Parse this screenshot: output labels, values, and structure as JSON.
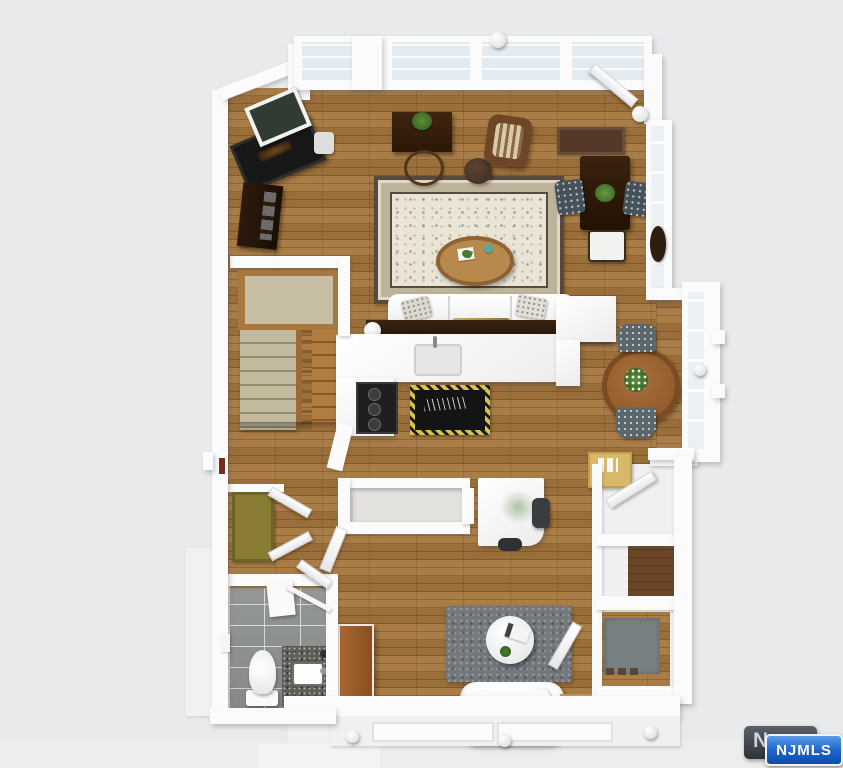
{
  "watermark": {
    "monogram": "N",
    "label": "NJMLS",
    "badge_blue": "#1a63c8",
    "badge_dark": "#3c4148"
  },
  "palette": {
    "background": "#e9eaeb",
    "wall": "#fbfbfc",
    "hardwood": "#a5763d",
    "hardwood_dark": "#6b4626",
    "window_glass": "#e4ebf0",
    "area_rug_ivory": "#eae4d4",
    "area_rug_border": "#57493e",
    "bath_tile_gray": "#8d918e",
    "shower_tile_beige": "#d9d2bc",
    "shag_rug_gray": "#73787c",
    "doormat_gray": "#798084",
    "stair_carpet_tan": "#c2ba9f",
    "granite_counter": "#5e5e59",
    "closet_door_olive": "#887d33",
    "armoire_wood": "#9a5a2a",
    "dark_wood_furniture": "#2c1a0c",
    "upholstery_floral": "#45525a",
    "kitchen_mat_black": "#141414",
    "kitchen_mat_trim": "#d8c24a"
  },
  "floorplan": {
    "view": "3d-rendered-top-down-floor-plan",
    "rooms": [
      {
        "name": "living-room",
        "floor": "hardwood",
        "items": [
          "fireplace",
          "wall-art",
          "media-console",
          "side-table-with-vase",
          "writing-desk",
          "potted-plant",
          "desk-chair",
          "rattan-armchair",
          "round-pouf",
          "oriental-area-rug",
          "oval-coffee-table",
          "white-sofa",
          "throw-pillows",
          "throw-blanket",
          "console-table",
          "pair-of-table-lamps",
          "window-wall"
        ]
      },
      {
        "name": "dining-corner",
        "floor": "hardwood",
        "items": [
          "dark-wood-table",
          "centerpiece-plant",
          "two-floral-chairs",
          "white-chair",
          "runner-rug",
          "oval-wall-mirror",
          "wall-sconce",
          "open-door"
        ]
      },
      {
        "name": "kitchen",
        "floor": "hardwood",
        "items": [
          "l-shaped-counter",
          "sink-with-faucet",
          "black-cooktop-range",
          "peninsula-cabinet",
          "decorative-black-mat"
        ]
      },
      {
        "name": "staircase",
        "floor": "carpet-and-wood",
        "items": [
          "carpeted-landing",
          "carpeted-flight",
          "wood-flight",
          "baluster-railing"
        ]
      },
      {
        "name": "breakfast-nook",
        "floor": "hardwood",
        "items": [
          "round-wood-table",
          "flower-centerpiece",
          "two-gray-chairs",
          "bay-window"
        ]
      },
      {
        "name": "office-area",
        "floor": "hardwood",
        "items": [
          "stairwell-railing",
          "white-desk",
          "green-desk-decal",
          "office-chair",
          "open-door",
          "memo-desk-with-pinboard"
        ]
      },
      {
        "name": "hallway",
        "floor": "hardwood",
        "items": [
          "olive-closet-door",
          "two-open-white-doors",
          "small-red-wall-art"
        ]
      },
      {
        "name": "bathroom",
        "floor": "gray-tile",
        "items": [
          "toilet",
          "granite-vanity",
          "white-sink",
          "shower-strip",
          "glass-shower-door",
          "wall-shelf",
          "towel-bar"
        ]
      },
      {
        "name": "family-room",
        "floor": "hardwood",
        "items": [
          "gray-shag-rug",
          "round-white-table",
          "magazine",
          "small-plant",
          "wood-armoire",
          "white-loveseat",
          "tan-seat-cushion",
          "two-end-tables",
          "round-lamp-decor",
          "open-door"
        ]
      },
      {
        "name": "entry-foyer",
        "floor": "hardwood",
        "items": [
          "gray-doormat",
          "shoe-row",
          "front-door-recess",
          "coat-closet"
        ]
      }
    ]
  }
}
